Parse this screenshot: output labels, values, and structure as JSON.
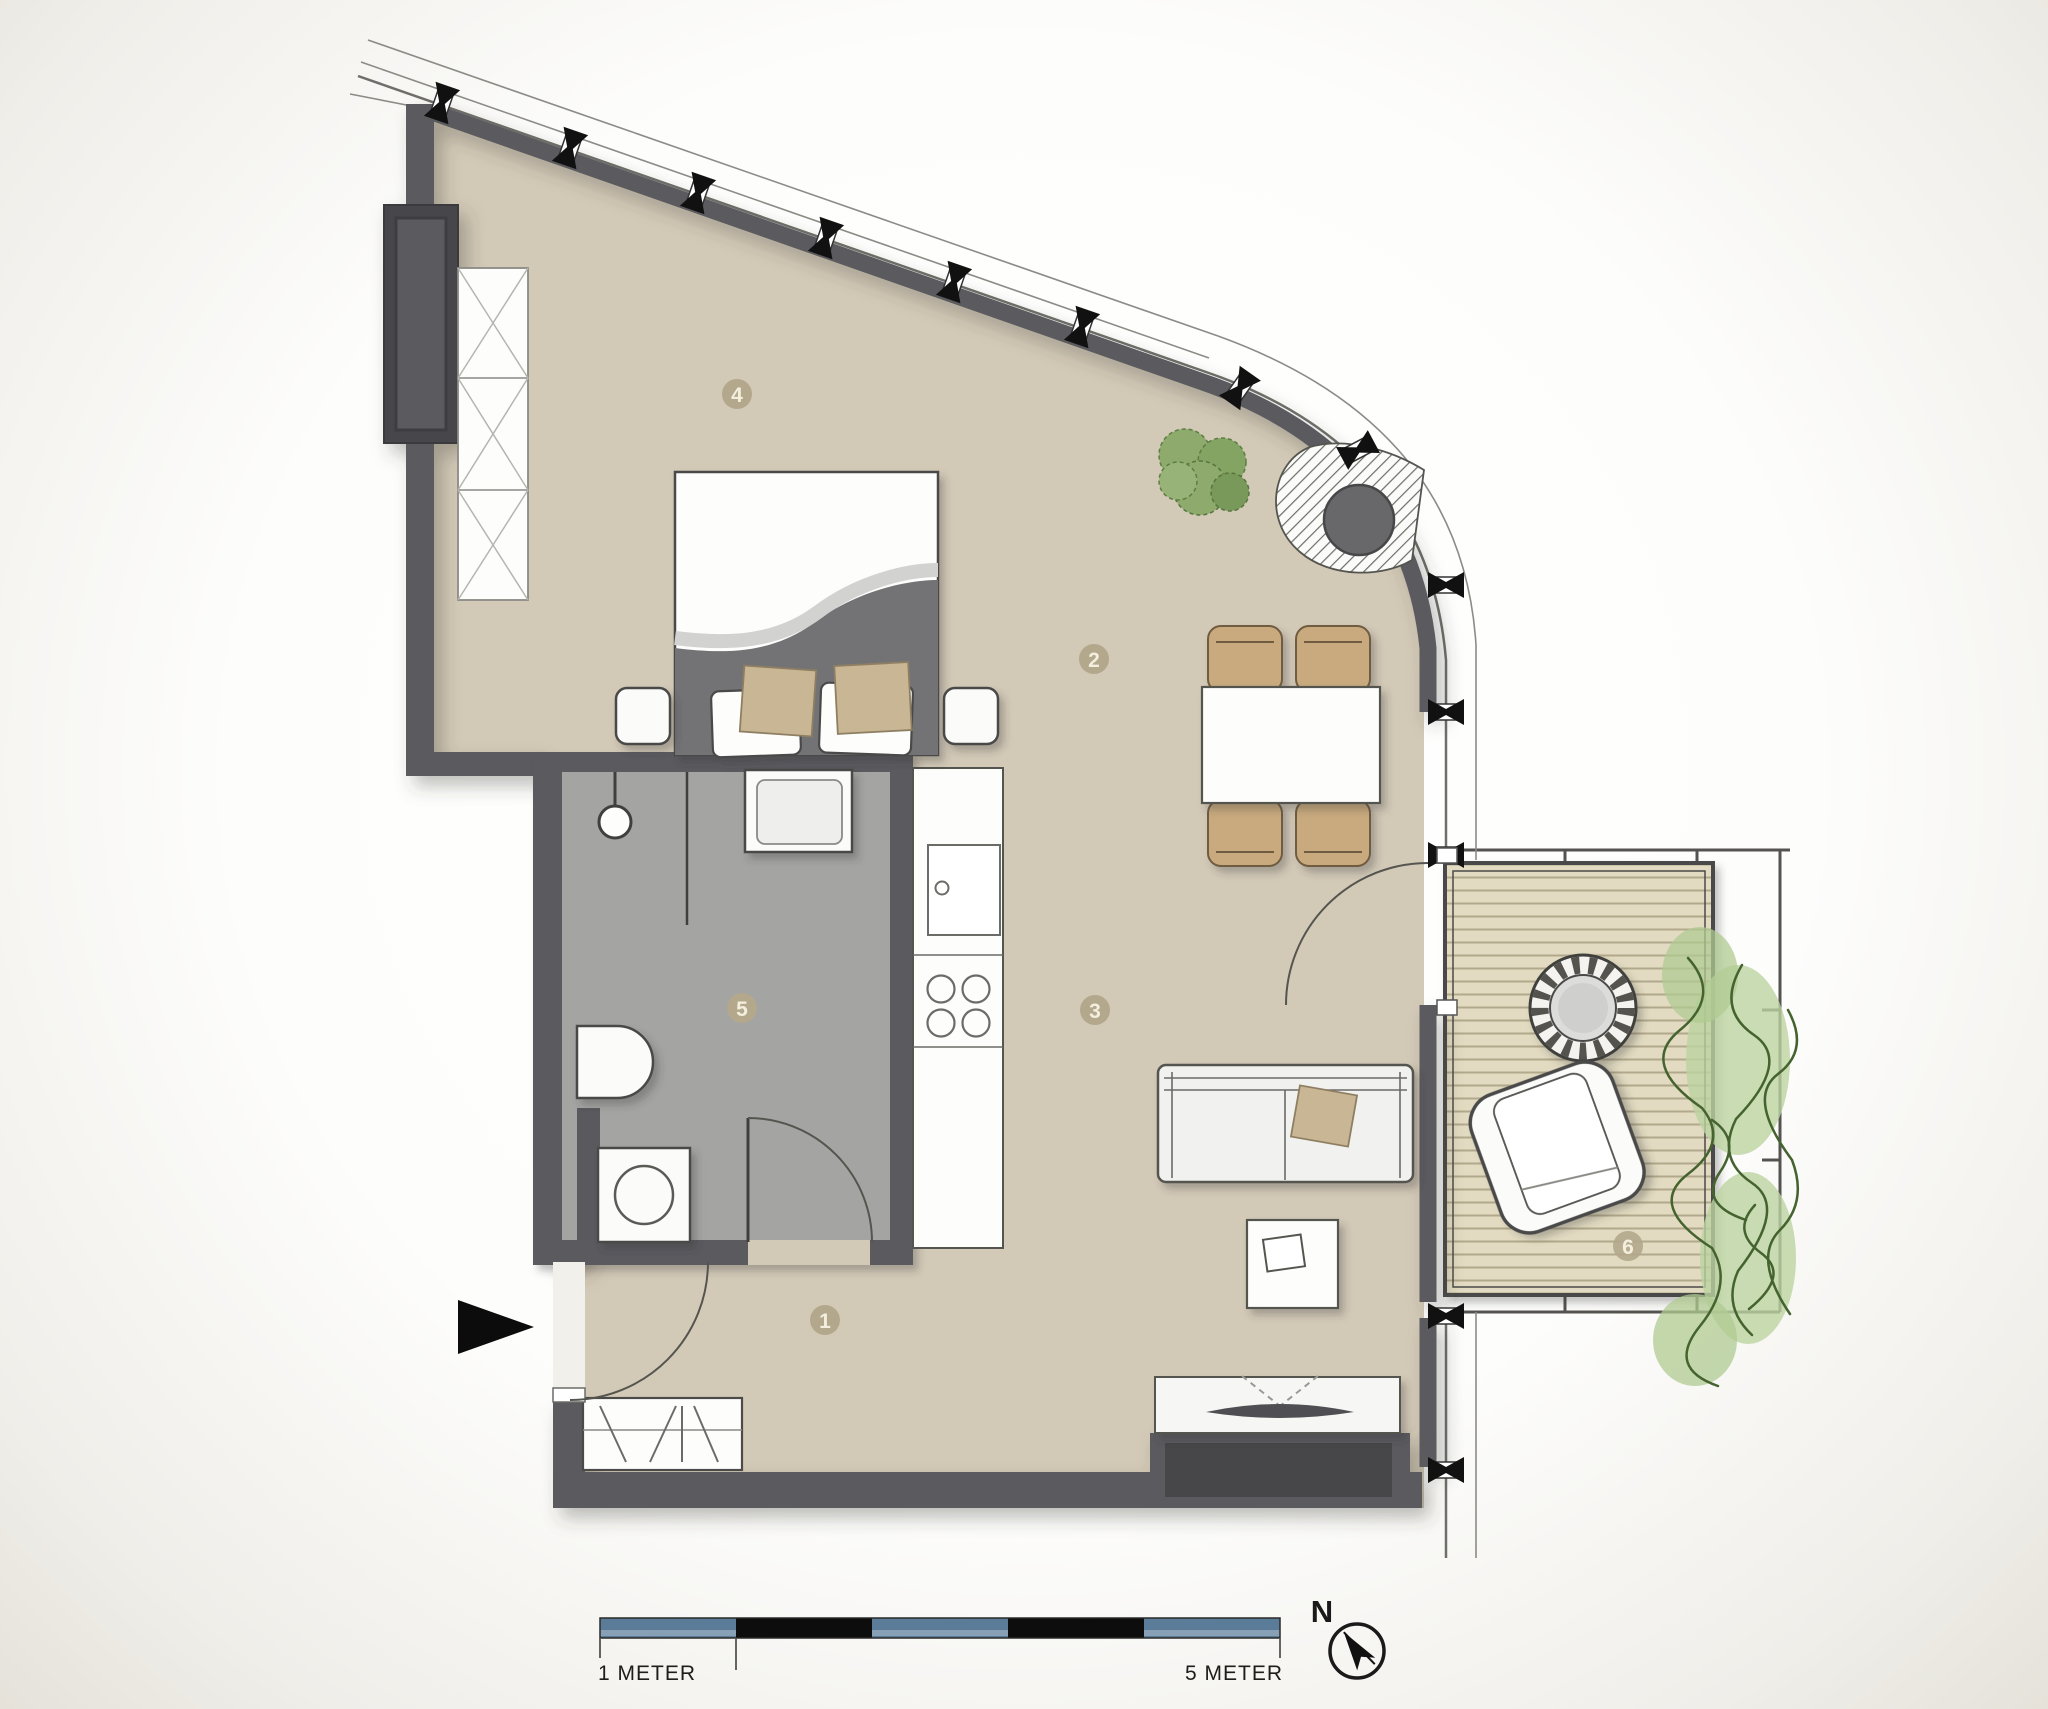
{
  "title": "Apartment floor plan",
  "room_labels": [
    {
      "number": "1"
    },
    {
      "number": "2"
    },
    {
      "number": "3"
    },
    {
      "number": "4"
    },
    {
      "number": "5"
    },
    {
      "number": "6"
    }
  ],
  "scale_bar": {
    "left_label": "1 METER",
    "right_label": "5 METER",
    "segments": [
      "blue",
      "black",
      "blue",
      "black",
      "blue"
    ]
  },
  "compass": {
    "label": "N"
  },
  "colors": {
    "floor-color": "#d3c9b7",
    "bathroom-floor-color": "#a4a4a2",
    "wall-color": "#5a5a5e",
    "deck-color": "#e2dbc1",
    "deck-line-color": "#b2a88b",
    "scale-blue": "#5a7c99",
    "scale-black": "#0d0d0d",
    "label-color": "#b3a78c",
    "chair-color": "#c8aa7e",
    "cushion-color": "#c9b694",
    "plant-color": "#8eab6d"
  }
}
